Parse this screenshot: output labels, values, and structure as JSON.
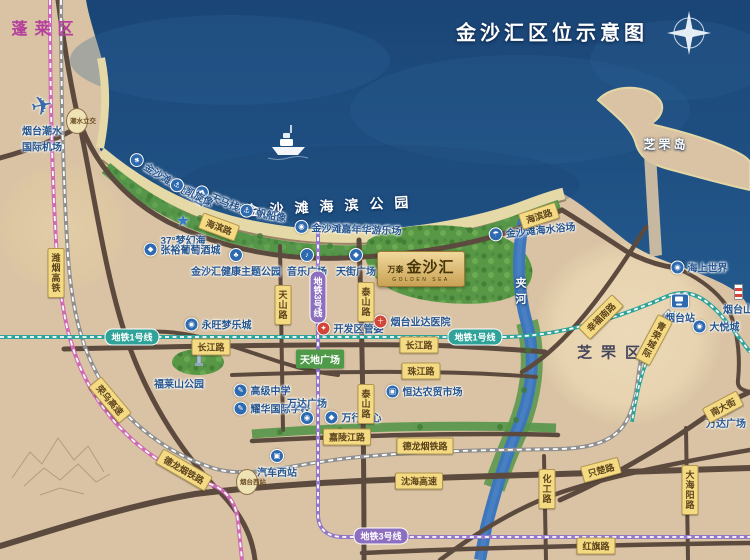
{
  "title": "金沙汇区位示意图",
  "districts": {
    "penglai": "蓬莱区",
    "zhifu": "芝罘区",
    "zhifu_island": "芝罘岛"
  },
  "water": {
    "jia_river": "夹河",
    "seaside_park": "金沙滩海滨公园"
  },
  "coast": {
    "wetland_park": "金沙滩湿地公园",
    "tianma_bridge": "天马栈桥",
    "kaixuan_statue": "凯旋像",
    "sailboat_statue": "帆船像",
    "carnival": "金沙滩嘉年华游乐场",
    "bathing_beach": "金沙滩海水浴场",
    "dream_sea": "37°梦幻海",
    "wine_city": "张裕葡萄酒城",
    "health_park": "金沙汇健康主题公园",
    "music_plaza": "音乐广场",
    "tianjie_plaza": "天街广场"
  },
  "project": {
    "brand": "万泰",
    "name": "金沙汇",
    "name_en": "GOLDEN SEA"
  },
  "pois": {
    "airport_l1": "烟台潮水",
    "airport_l2": "国际机场",
    "aeon": "永旺梦乐城",
    "admin": "开发区管委",
    "hospital": "烟台业达医院",
    "tiandi": "天地广场",
    "market": "恒达农贸市场",
    "fulai_park": "福莱山公园",
    "high_school": "高级中学",
    "intl_school": "耀华国际学校",
    "wanda_west": "万达广场",
    "wanxing": "万行中心",
    "bus_station": "汽车西站",
    "sea_world": "海上世界",
    "yantai_station": "烟台站",
    "yantai_hill": "烟台山",
    "joy_city": "大悦城",
    "wanda_east": "万达广场"
  },
  "roads": {
    "haibin": "海滨路",
    "tianshan": "天山路",
    "taishan": "泰山路",
    "changjiang": "长江路",
    "zhujiang": "珠江路",
    "jialing": "嘉陵江路",
    "zhichu": "只楚路",
    "huagong": "化工路",
    "hongqi": "红旗路",
    "nandajie": "南大街",
    "dahaiyang": "大海阳路",
    "xingfu": "幸福南路",
    "shenhai": "沈海高速",
    "rongwu": "荣乌高速"
  },
  "rail": {
    "weiyan": "潍烟高铁",
    "delongyan": "德龙烟铁路",
    "qingrong": "青荣城际",
    "metro1": "地铁1号线",
    "metro3": "地铁3号线"
  },
  "markers": {
    "west_station": "烟台西站",
    "chaoshui_hub": "潮水立交"
  },
  "icons": {
    "park": "♣",
    "bridge": "◆",
    "statue": "⚓",
    "carnival": "◉",
    "beach": "☂",
    "star": "★",
    "wine": "◆",
    "music": "♪",
    "plaza": "◆",
    "admin": "✦",
    "hospital": "＋",
    "mall": "◉",
    "school": "✎",
    "market": "▣",
    "bus": "▣",
    "ship": "◉",
    "plane": "✈"
  },
  "colors": {
    "sea": "#1d4e84",
    "land": "#d9c3a4",
    "road": "#5d4a3e",
    "road_label_bg": "#f4da82",
    "metro1": "#2fa399",
    "metro3": "#8d6fc0",
    "hsr": "#cf6ab5",
    "gold": "#c9a254",
    "poi_blue": "#2d6ab0",
    "poi_red": "#d24538",
    "green": "#55964a"
  }
}
